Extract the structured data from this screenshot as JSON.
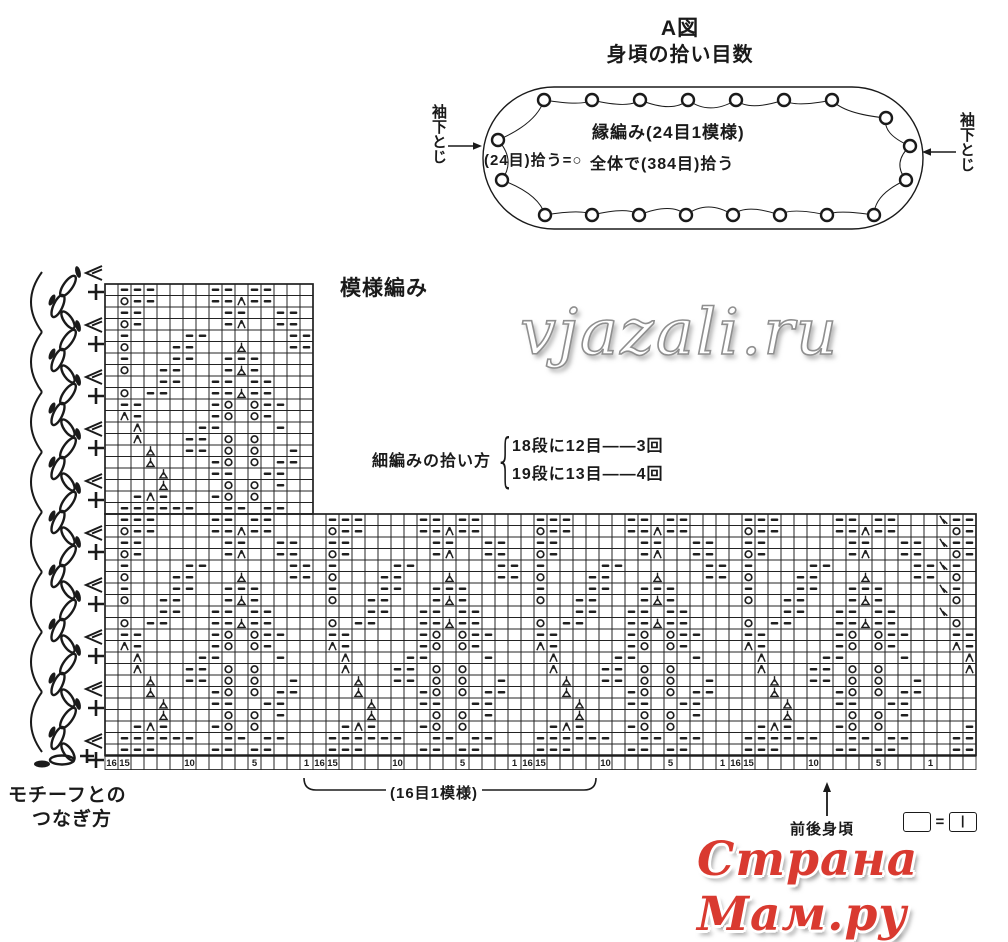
{
  "header": {
    "title": "A図",
    "subtitle": "身頃の拾い目数"
  },
  "oval_diagram": {
    "label_main": "縁編み(24目1模様)",
    "label_total": "全体で(384目)拾う",
    "pickup_label": "(24目)拾う=○",
    "left_label": "袖下とじ",
    "right_label": "袖下とじ",
    "circle_counts": {
      "top": 7,
      "right": 3,
      "bottom": 8,
      "left": 2
    }
  },
  "pattern_section": {
    "label": "模様編み",
    "pickup_note": {
      "label": "細編みの拾い方",
      "line1": "18段に12目――3回",
      "line2": "19段に13目――4回"
    }
  },
  "grid": {
    "cell_w": 13,
    "cell_h": 11.5,
    "narrow_cols": 16,
    "narrow_rows": 20,
    "wide_cols": 67,
    "wide_rows": 21,
    "symbol_legend": {
      "-": "purl",
      "o": "yarn-over",
      "A": "double-decrease",
      "T": "central-decrease-stem",
      "/": "right-decrease"
    },
    "repeat_rows": [
      ".---....--.--...",
      ".o--....--A--...",
      ".--......--..--.",
      ".o-......-A..--.",
      ".-....--......--",
      ".o...--...T...--",
      ".-...--..---....",
      ".o..--...-T-....",
      "....--..--.--...",
      ".o.--...--T--...",
      ".--.....-o.o--..",
      ".A-.....-o.o-...",
      "..A....--....-..",
      "..A...--.o.o....",
      "...T..--.o.o..-.",
      "...T....-o.o.--.",
      "....T...--..--..",
      "....T....o.o.-..",
      "..-A-...-o.o....",
      ".------..--.--.."
    ],
    "right_edge": {
      "cols_from_right": 3,
      "rows": [
        0,
        2,
        4,
        6,
        8
      ],
      "symbol": "/"
    },
    "numbers": {
      "labels": [
        "16",
        "15",
        "10",
        "5",
        "1"
      ],
      "offsets": [
        0,
        1,
        6,
        11,
        15
      ],
      "repeat": 16,
      "runs": 4
    }
  },
  "edging": {
    "scallops": 8,
    "chain_peaks": 9,
    "plus_marks": 10,
    "join_triangles": 10
  },
  "footer": {
    "motif_label_line1": "モチーフとの",
    "motif_label_line2": "つなぎ方",
    "repeat_brace_label": "(16目1模様)",
    "body_label": "前後身頃",
    "legend": {
      "left_box": "",
      "equals": "=",
      "right_box": "|"
    }
  },
  "watermarks": {
    "center": "vjazali.ru",
    "bottom_right": "Страна Мам.ру"
  }
}
